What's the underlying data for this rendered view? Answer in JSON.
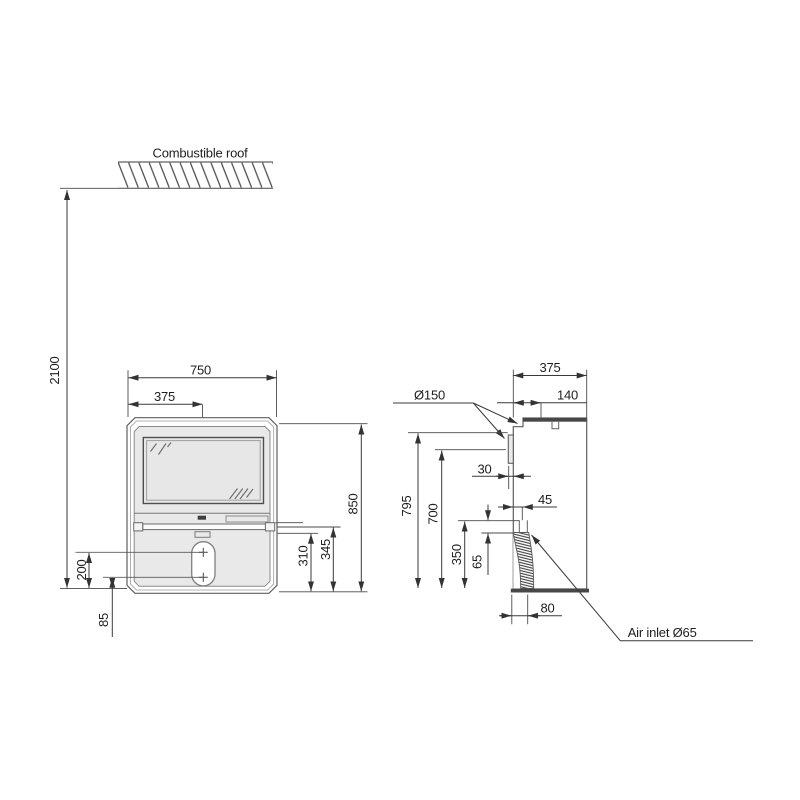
{
  "roof": {
    "label": "Combustible roof"
  },
  "clearance": {
    "height_to_roof": "2100"
  },
  "front_view": {
    "width": "750",
    "half_width": "375",
    "height": "850",
    "shelf_top_to_floor": "345",
    "shelf_bottom_to_floor": "310",
    "upper_knob_height": "200",
    "lower_knob_height": "85"
  },
  "side_view": {
    "depth": "375",
    "flue_diameter_label": "Ø150",
    "flue_center_from_back": "140",
    "rear_outlet_offset": "30",
    "rear_outlet_top_height": "795",
    "rear_outlet_center_height": "700",
    "air_inlet_height": "350",
    "air_inlet_span": "65",
    "air_inlet_offset": "45",
    "air_inlet_floor_offset": "80",
    "air_inlet_label": "Air inlet Ø65"
  },
  "colors": {
    "outline": "#5f5f5f",
    "dimension": "#3a3a3a",
    "body_fill": "#e9e9e9",
    "glass_fill": "#e7e7e7",
    "dark_fill": "#474747",
    "text": "#1e1e1e"
  }
}
